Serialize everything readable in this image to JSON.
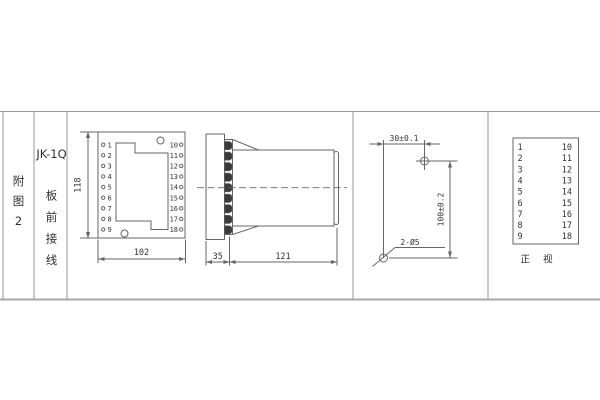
{
  "left_panel": {
    "figure_label": [
      "附",
      "图",
      "2"
    ]
  },
  "model_panel": {
    "model": "JK-1Q",
    "wiring_label": [
      "板",
      "前",
      "接",
      "线"
    ]
  },
  "front_view": {
    "left_terminals": [
      "1",
      "2",
      "3",
      "4",
      "5",
      "6",
      "7",
      "8",
      "9"
    ],
    "right_terminals": [
      "10",
      "11",
      "12",
      "13",
      "14",
      "15",
      "16",
      "17",
      "18"
    ],
    "height_dim": "118",
    "width_dim": "102"
  },
  "side_view": {
    "front_depth_dim": "35",
    "body_depth_dim": "121"
  },
  "drill_view": {
    "hole_spacing_h": "30±0.1",
    "hole_spacing_v": "100±0.2",
    "hole_spec": "2-Ø5"
  },
  "terminal_table": {
    "left_column": [
      "1",
      "2",
      "3",
      "4",
      "5",
      "6",
      "7",
      "8",
      "9"
    ],
    "right_column": [
      "10",
      "11",
      "12",
      "13",
      "14",
      "15",
      "16",
      "17",
      "18"
    ],
    "caption": "正 视"
  },
  "colors": {
    "line": "#666666",
    "frame": "#9a9a9a",
    "text": "#333333"
  }
}
